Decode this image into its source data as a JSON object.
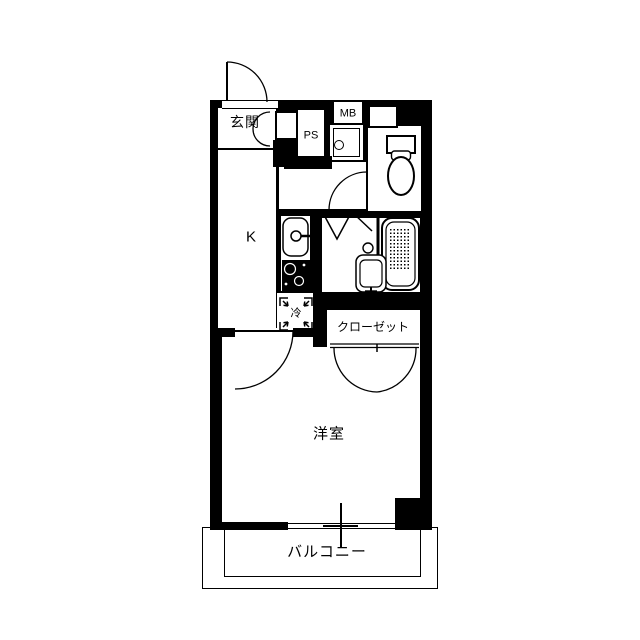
{
  "title": "1K apartment floor plan",
  "colors": {
    "wall": "#000000",
    "floor": "#ffffff",
    "line": "#000000"
  },
  "rooms": {
    "entrance": {
      "label": "玄関"
    },
    "pipe_shaft": {
      "label": "PS"
    },
    "meter_box": {
      "label": "MB"
    },
    "kitchen": {
      "label": "K"
    },
    "refrigerator_space": {
      "label": "冷"
    },
    "closet": {
      "label": "クローゼット"
    },
    "western_room": {
      "label": "洋室"
    },
    "balcony": {
      "label": "バルコニー"
    }
  },
  "fixtures": [
    "entrance-door-swing",
    "shoe-cabinet",
    "washing-machine-pan",
    "toilet",
    "toilet-door-swing",
    "bath-folding-door",
    "bathtub",
    "washbasin",
    "kitchen-sink",
    "gas-stove",
    "refrigerator-space-marks",
    "room-door-swing",
    "closet-double-door-swing",
    "sliding-window",
    "balcony-rail"
  ]
}
